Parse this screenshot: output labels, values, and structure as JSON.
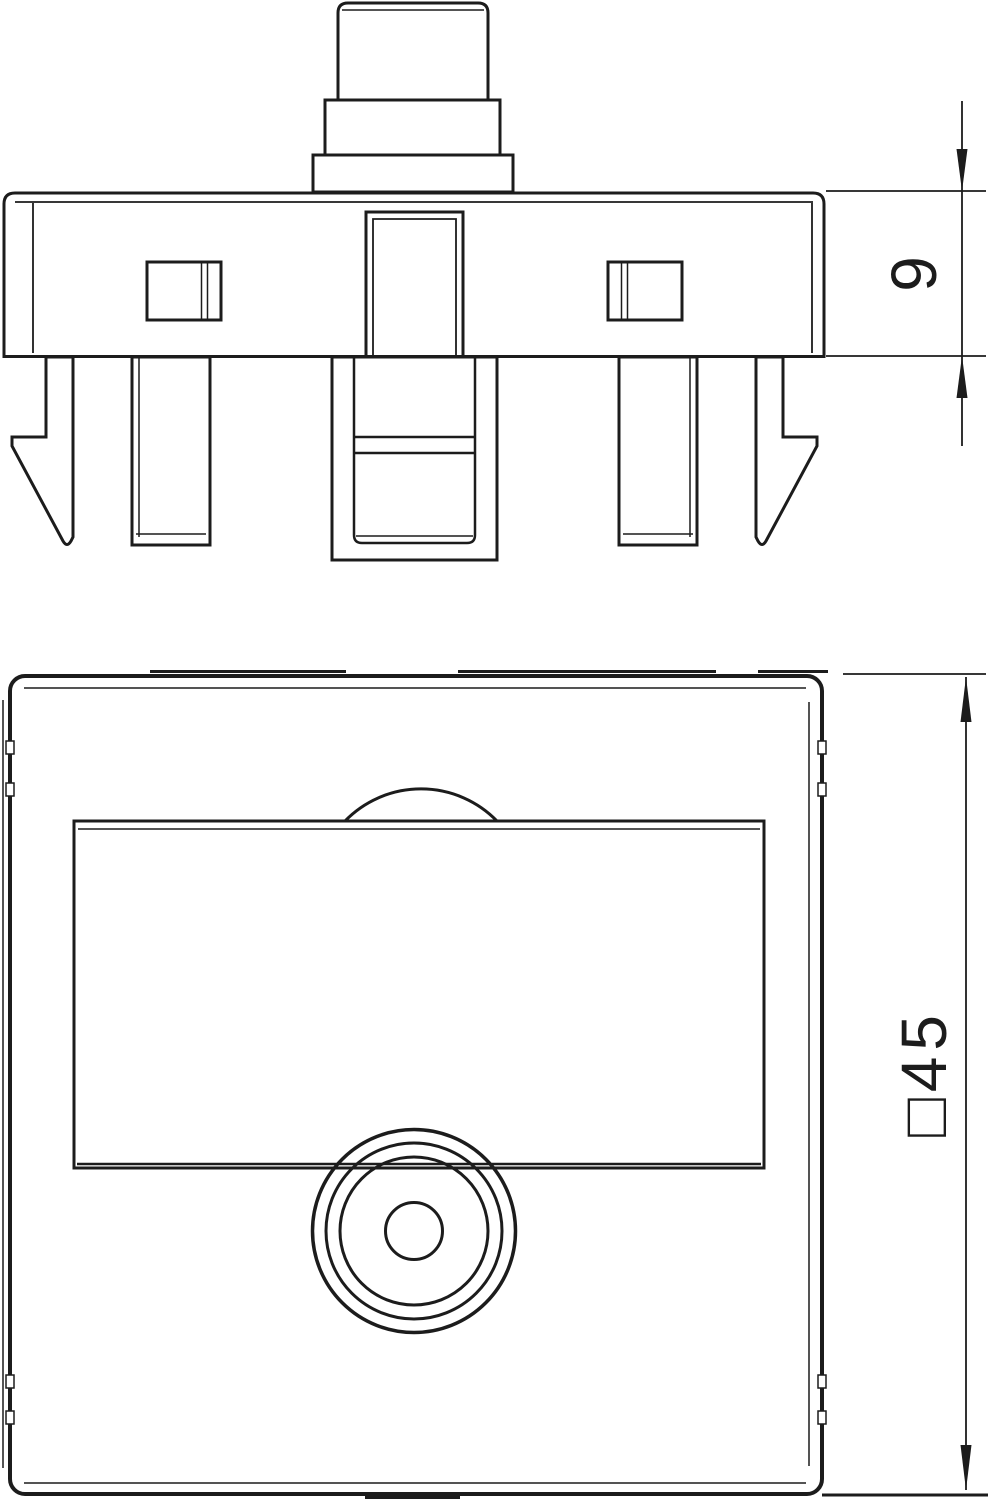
{
  "page": {
    "background": "#ffffff",
    "ink": "#1c1c1c"
  },
  "dimensions": {
    "plate_thickness": {
      "label": "9"
    },
    "plate_size": {
      "label": "□45"
    }
  }
}
